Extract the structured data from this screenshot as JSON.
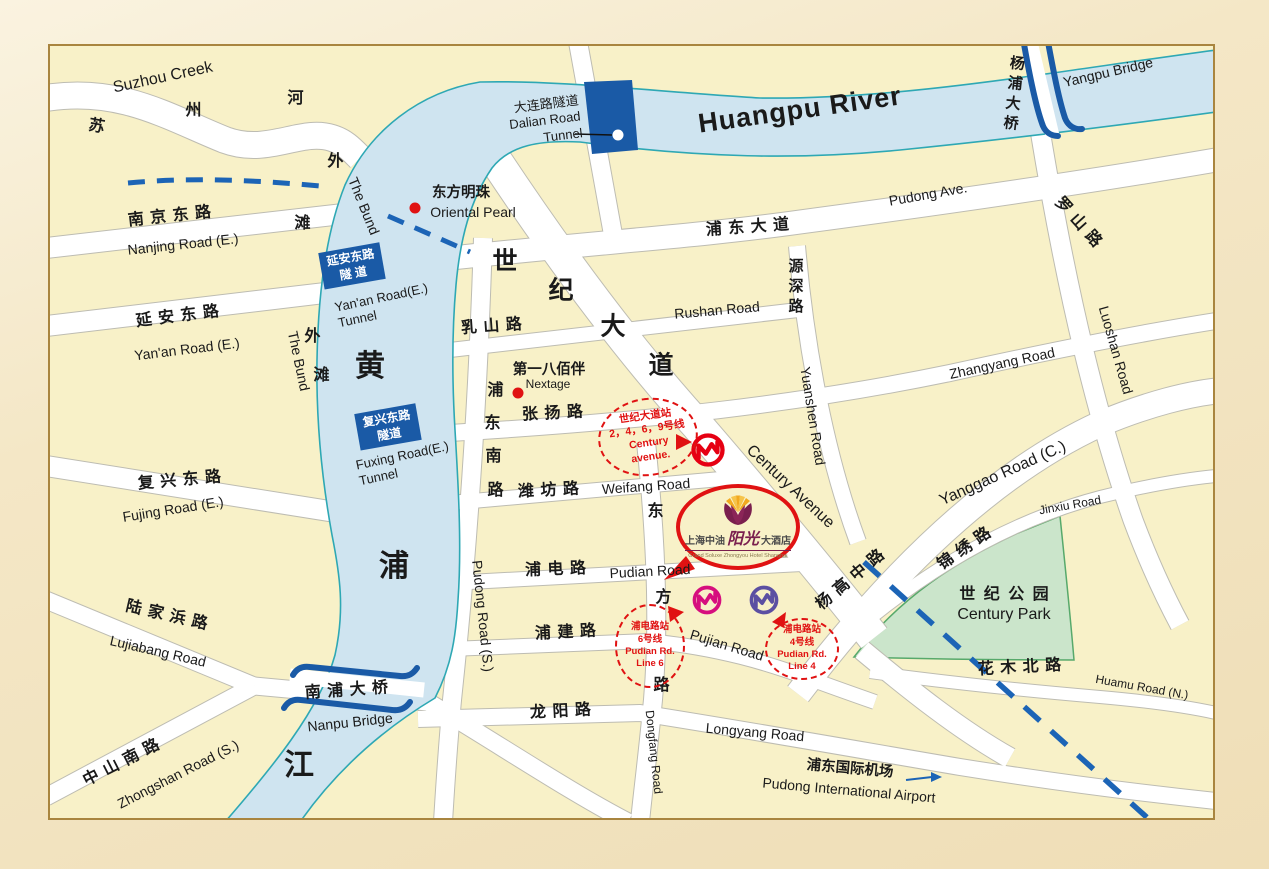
{
  "colors": {
    "outer": "#F2E3BE",
    "panel": "#F8F1C8",
    "border": "#A9853F",
    "road": "#FFFFFF",
    "roadEdge": "#BDBCB2",
    "river": "#CFE4F0",
    "riverEdge": "#2EA8B4",
    "bridge": "#1A5AA6",
    "metro": "#1C64B6",
    "red": "#E01212",
    "park": "#CBE5CB",
    "parkEdge": "#57A96B",
    "line2469": "#E60012",
    "line6": "#D60F7E",
    "line4": "#5B4FA2",
    "text": "#1A1A1A",
    "hotelPlum": "#7A1F4E",
    "hotelGold": "#F2A91F"
  },
  "labels": [
    {
      "n": "suzhou-creek-en",
      "t": "Suzhou Creek",
      "x": 163,
      "y": 78,
      "r": -12,
      "c": "en-lg"
    },
    {
      "n": "suzhou-creek-cn-1",
      "t": "苏",
      "x": 97,
      "y": 127,
      "r": 10,
      "c": "cn"
    },
    {
      "n": "suzhou-creek-cn-2",
      "t": "州",
      "x": 194,
      "y": 111,
      "r": 0,
      "c": "cn"
    },
    {
      "n": "suzhou-creek-cn-3",
      "t": "河",
      "x": 296,
      "y": 99,
      "r": 0,
      "c": "cn"
    },
    {
      "n": "nanjing-road-cn",
      "t": "南 京 东 路",
      "x": 170,
      "y": 217,
      "r": -6,
      "c": "cn"
    },
    {
      "n": "nanjing-road-en",
      "t": "Nanjing Road (E.)",
      "x": 183,
      "y": 244,
      "r": -6,
      "c": "en"
    },
    {
      "n": "yanan-road-cn",
      "t": "延 安 东 路",
      "x": 178,
      "y": 317,
      "r": -7,
      "c": "cn"
    },
    {
      "n": "yanan-road-en",
      "t": "Yan'an Road (E.)",
      "x": 187,
      "y": 349,
      "r": -7,
      "c": "en"
    },
    {
      "n": "fuxing-road-cn",
      "t": "复 兴 东 路",
      "x": 180,
      "y": 481,
      "r": -5,
      "c": "cn"
    },
    {
      "n": "fujing-road-en",
      "t": "Fujing Road (E.)",
      "x": 173,
      "y": 509,
      "r": -9,
      "c": "en"
    },
    {
      "n": "lujiabang-road-cn",
      "t": "陆 家 浜 路",
      "x": 167,
      "y": 616,
      "r": 13,
      "c": "cn"
    },
    {
      "n": "lujiabang-road-en",
      "t": "Lujiabang Road",
      "x": 158,
      "y": 651,
      "r": 13,
      "c": "en"
    },
    {
      "n": "zhongshan-road-cn",
      "t": "中 山 南 路",
      "x": 122,
      "y": 763,
      "r": -27,
      "c": "cn"
    },
    {
      "n": "zhongshan-road-en",
      "t": "Zhongshan Road (S.)",
      "x": 178,
      "y": 774,
      "r": -27,
      "c": "en"
    },
    {
      "n": "the-bund-en-north",
      "t": "The Bund",
      "x": 364,
      "y": 206,
      "r": 68,
      "c": "en"
    },
    {
      "n": "waitan-cn-north-1",
      "t": "外",
      "x": 336,
      "y": 162,
      "r": 0,
      "c": "cn"
    },
    {
      "n": "waitan-cn-north-2",
      "t": "滩",
      "x": 303,
      "y": 224,
      "r": 0,
      "c": "cn"
    },
    {
      "n": "the-bund-en-south",
      "t": "The Bund",
      "x": 299,
      "y": 361,
      "r": 78,
      "c": "en"
    },
    {
      "n": "waitan-cn-south-1",
      "t": "外",
      "x": 313,
      "y": 337,
      "r": 0,
      "c": "cn"
    },
    {
      "n": "waitan-cn-south-2",
      "t": "滩",
      "x": 322,
      "y": 376,
      "r": 0,
      "c": "cn"
    },
    {
      "n": "huangpu-river-en",
      "t": "Huangpu River",
      "x": 800,
      "y": 110,
      "r": -8,
      "c": "river-en"
    },
    {
      "n": "huangpu-cn-1",
      "t": "黄",
      "x": 370,
      "y": 367,
      "r": 0,
      "c": "huge"
    },
    {
      "n": "huangpu-cn-2",
      "t": "浦",
      "x": 394,
      "y": 567,
      "r": 0,
      "c": "huge"
    },
    {
      "n": "huangpu-cn-3",
      "t": "江",
      "x": 299,
      "y": 766,
      "r": 0,
      "c": "huge"
    },
    {
      "n": "nanpu-bridge-cn",
      "t": "南 浦 大 桥",
      "x": 347,
      "y": 691,
      "r": -4,
      "c": "cn"
    },
    {
      "n": "nanpu-bridge-en",
      "t": "Nanpu Bridge",
      "x": 350,
      "y": 722,
      "r": -6,
      "c": "en"
    },
    {
      "n": "yangpu-bridge-cn",
      "t": "杨浦大桥",
      "x": 1013,
      "y": 95,
      "r": 6,
      "c": "cn-vert"
    },
    {
      "n": "yangpu-bridge-en",
      "t": "Yangpu Bridge",
      "x": 1108,
      "y": 72,
      "r": -13,
      "c": "en"
    },
    {
      "n": "oriental-pearl-cn",
      "t": "东方明珠",
      "x": 461,
      "y": 193,
      "r": 0,
      "c": "cn-plain"
    },
    {
      "n": "oriental-pearl-en",
      "t": "Oriental Pearl",
      "x": 473,
      "y": 212,
      "r": 0,
      "c": "en"
    },
    {
      "n": "pudong-ave-cn",
      "t": "浦 东 大 道",
      "x": 748,
      "y": 228,
      "r": -4,
      "c": "cn"
    },
    {
      "n": "pudong-ave-en",
      "t": "Pudong Ave.",
      "x": 928,
      "y": 194,
      "r": -10,
      "c": "en"
    },
    {
      "n": "rushan-road-cn",
      "t": "乳 山 路",
      "x": 492,
      "y": 327,
      "r": -4,
      "c": "cn"
    },
    {
      "n": "rushan-road-en",
      "t": "Rushan Road",
      "x": 717,
      "y": 310,
      "r": -5,
      "c": "en"
    },
    {
      "n": "century-ave-cn-1",
      "t": "世",
      "x": 505,
      "y": 262,
      "r": 0,
      "c": "big"
    },
    {
      "n": "century-ave-cn-2",
      "t": "纪",
      "x": 561,
      "y": 291,
      "r": 0,
      "c": "big"
    },
    {
      "n": "century-ave-cn-3",
      "t": "大",
      "x": 613,
      "y": 327,
      "r": 0,
      "c": "big"
    },
    {
      "n": "century-ave-cn-4",
      "t": "道",
      "x": 661,
      "y": 366,
      "r": 0,
      "c": "big"
    },
    {
      "n": "century-ave-en",
      "t": "Century Avenue",
      "x": 790,
      "y": 487,
      "r": 43,
      "c": "en-lg"
    },
    {
      "n": "yuanshen-road-cn",
      "t": "源深路",
      "x": 795,
      "y": 288,
      "r": 0,
      "c": "cn-vert"
    },
    {
      "n": "yuanshen-road-en",
      "t": "Yuanshen Road",
      "x": 813,
      "y": 416,
      "r": 81,
      "c": "en"
    },
    {
      "n": "zhangyang-road-cn",
      "t": "张 扬 路",
      "x": 553,
      "y": 414,
      "r": -3,
      "c": "cn"
    },
    {
      "n": "zhangyang-road-en",
      "t": "Zhangyang Road",
      "x": 1002,
      "y": 363,
      "r": -12,
      "c": "en"
    },
    {
      "n": "nextage-cn",
      "t": "第一八佰伴",
      "x": 549,
      "y": 370,
      "r": 0,
      "c": "cn-plain"
    },
    {
      "n": "nextage-en",
      "t": "Nextage",
      "x": 548,
      "y": 384,
      "r": 0,
      "c": "en-sm"
    },
    {
      "n": "pudongnan-road-cn-1",
      "t": "浦",
      "x": 496,
      "y": 391,
      "r": 0,
      "c": "cn"
    },
    {
      "n": "pudongnan-road-cn-2",
      "t": "东",
      "x": 493,
      "y": 424,
      "r": 0,
      "c": "cn"
    },
    {
      "n": "pudongnan-road-cn-3",
      "t": "南",
      "x": 494,
      "y": 457,
      "r": 0,
      "c": "cn"
    },
    {
      "n": "pudongnan-road-cn-4",
      "t": "路",
      "x": 496,
      "y": 491,
      "r": 0,
      "c": "cn"
    },
    {
      "n": "pudong-road-s-en",
      "t": "Pudong Road (S.)",
      "x": 483,
      "y": 616,
      "r": 84,
      "c": "en"
    },
    {
      "n": "weifang-road-cn",
      "t": "潍 坊 路",
      "x": 549,
      "y": 491,
      "r": -3,
      "c": "cn"
    },
    {
      "n": "weifang-road-en",
      "t": "Weifang Road",
      "x": 646,
      "y": 486,
      "r": -4,
      "c": "en"
    },
    {
      "n": "dongfang-road-cn-1",
      "t": "东",
      "x": 656,
      "y": 512,
      "r": 0,
      "c": "cn"
    },
    {
      "n": "dongfang-road-cn-2",
      "t": "方",
      "x": 664,
      "y": 598,
      "r": 0,
      "c": "cn"
    },
    {
      "n": "dongfang-road-cn-3",
      "t": "路",
      "x": 662,
      "y": 686,
      "r": 0,
      "c": "cn"
    },
    {
      "n": "dongfang-road-en",
      "t": "Dongfang Road",
      "x": 654,
      "y": 752,
      "r": 84,
      "c": "en-sm"
    },
    {
      "n": "pudian-road-cn",
      "t": "浦 电 路",
      "x": 556,
      "y": 570,
      "r": -2,
      "c": "cn"
    },
    {
      "n": "pudian-road-en",
      "t": "Pudian Road",
      "x": 650,
      "y": 571,
      "r": -3,
      "c": "en"
    },
    {
      "n": "pujian-road-cn",
      "t": "浦 建 路",
      "x": 566,
      "y": 633,
      "r": -3,
      "c": "cn"
    },
    {
      "n": "pujian-road-en",
      "t": "Pujian Road",
      "x": 727,
      "y": 645,
      "r": 17,
      "c": "en"
    },
    {
      "n": "longyang-road-cn",
      "t": "龙 阳 路",
      "x": 561,
      "y": 712,
      "r": -3,
      "c": "cn"
    },
    {
      "n": "longyang-road-en",
      "t": "Longyang Road",
      "x": 755,
      "y": 732,
      "r": 5,
      "c": "en"
    },
    {
      "n": "pudong-airport-cn",
      "t": "浦东国际机场",
      "x": 850,
      "y": 769,
      "r": 5,
      "c": "cn-plain"
    },
    {
      "n": "pudong-airport-en",
      "t": "Pudong International Airport",
      "x": 849,
      "y": 790,
      "r": 5,
      "c": "en"
    },
    {
      "n": "century-park-cn",
      "t": "世 纪 公 园",
      "x": 1005,
      "y": 595,
      "r": 0,
      "c": "cn-park"
    },
    {
      "n": "century-park-en",
      "t": "Century Park",
      "x": 1004,
      "y": 615,
      "r": 0,
      "c": "en-lg"
    },
    {
      "n": "jinxiu-road-cn",
      "t": "锦 绣 路",
      "x": 965,
      "y": 549,
      "r": -35,
      "c": "cn"
    },
    {
      "n": "jinxiu-road-en",
      "t": "Jinxiu Road",
      "x": 1070,
      "y": 505,
      "r": -10,
      "c": "en-sm"
    },
    {
      "n": "yanggao-road-en",
      "t": "Yanggao Road (C.)",
      "x": 1003,
      "y": 474,
      "r": -24,
      "c": "en-lg"
    },
    {
      "n": "yanggao-road-cn",
      "t": "杨 高 中 路",
      "x": 851,
      "y": 580,
      "r": -40,
      "c": "cn"
    },
    {
      "n": "huamu-road-cn",
      "t": "花 木 北 路",
      "x": 1020,
      "y": 668,
      "r": -3,
      "c": "cn"
    },
    {
      "n": "huamu-road-en",
      "t": "Huamu Road (N.)",
      "x": 1142,
      "y": 687,
      "r": 10,
      "c": "en-sm"
    },
    {
      "n": "luoshan-road-cn",
      "t": "罗 山 路",
      "x": 1078,
      "y": 223,
      "r": 48,
      "c": "cn"
    },
    {
      "n": "luoshan-road-en",
      "t": "Luoshan Road",
      "x": 1116,
      "y": 350,
      "r": 74,
      "c": "en"
    }
  ],
  "tunnel_boxes": [
    {
      "n": "yanan-tunnel-box",
      "x": 352,
      "y": 266,
      "r": -10,
      "lines": [
        "延安东路",
        "隧 道"
      ]
    },
    {
      "n": "fuxing-tunnel-box",
      "x": 388,
      "y": 427,
      "r": -10,
      "lines": [
        "复兴东路",
        "隧道"
      ]
    }
  ],
  "tunnel_texts": [
    {
      "n": "dalian-tunnel-label",
      "x": 545,
      "y": 121,
      "r": -7,
      "align": "right",
      "lines": [
        "大连路隧道",
        "Dalian Road",
        "Tunnel"
      ]
    },
    {
      "n": "yanan-tunnel-label-en",
      "x": 383,
      "y": 306,
      "r": -12,
      "align": "left",
      "lines": [
        "Yan'an Road(E.)",
        "Tunnel"
      ]
    },
    {
      "n": "fuxing-tunnel-label-en",
      "x": 404,
      "y": 464,
      "r": -12,
      "align": "left",
      "lines": [
        "Fuxing Road(E.)",
        "Tunnel"
      ]
    }
  ],
  "stations": [
    {
      "n": "century-avenue-station",
      "x": 648,
      "y": 437,
      "w": 100,
      "h": 78,
      "r": -8,
      "fs": 10.5,
      "lines": [
        "世纪大道站",
        "2，4，6，9号线",
        "Century",
        "avenue."
      ]
    },
    {
      "n": "pudian-line6-station",
      "x": 650,
      "y": 646,
      "w": 70,
      "h": 84,
      "r": 0,
      "fs": 9.5,
      "lines": [
        "浦电路站",
        "6号线",
        "Pudian Rd.",
        "Line 6"
      ]
    },
    {
      "n": "pudian-line4-station",
      "x": 802,
      "y": 649,
      "w": 74,
      "h": 62,
      "r": 0,
      "fs": 9.5,
      "lines": [
        "浦电路站",
        "4号线",
        "Pudian Rd.",
        "Line 4"
      ]
    }
  ],
  "hotel": {
    "zh_pre": "上海中油",
    "zh_script": "阳光",
    "zh_post": "大酒店",
    "en": "Grand Soluxe Zhongyou Hotel Shanghai"
  }
}
